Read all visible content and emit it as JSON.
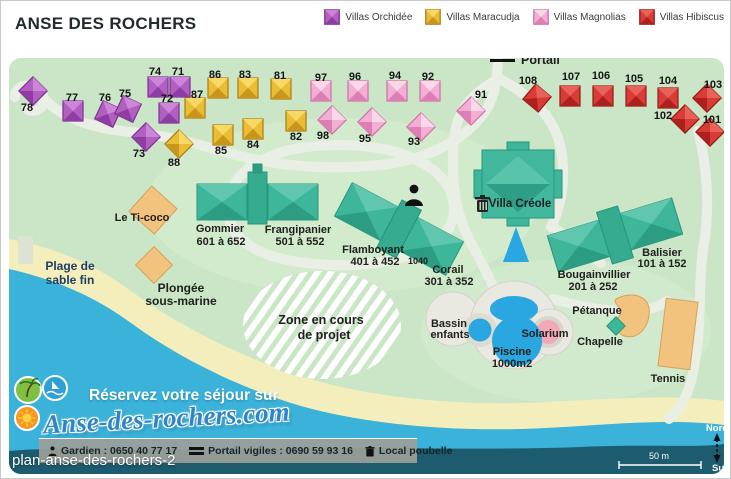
{
  "header": {
    "title": "ANSE DES ROCHERS",
    "legend": [
      {
        "label": "Villas Orchidée",
        "type": "orchidee"
      },
      {
        "label": "Villas Maracudja",
        "type": "maracudja"
      },
      {
        "label": "Villas Magnolias",
        "type": "magnolias"
      },
      {
        "label": "Villas Hibiscus",
        "type": "hibiscus"
      }
    ]
  },
  "map": {
    "villa_types": {
      "orchidee": {
        "light": "#cd85da",
        "mid": "#b160c2",
        "dark": "#8f3da4",
        "edge": "#7c2f92"
      },
      "maracudja": {
        "light": "#f6d967",
        "mid": "#eabd37",
        "dark": "#c9961b",
        "edge": "#ab7d10"
      },
      "magnolias": {
        "light": "#fad7e9",
        "mid": "#f3afd3",
        "dark": "#dd7fb5",
        "edge": "#ce6fa8"
      },
      "hibiscus": {
        "light": "#e8625a",
        "mid": "#d93c37",
        "dark": "#ad201e",
        "edge": "#901815"
      }
    },
    "villas": [
      {
        "n": "78",
        "t": "orchidee",
        "x": 32,
        "y": 90,
        "r": 45,
        "lx": 26,
        "ly": 110
      },
      {
        "n": "77",
        "t": "orchidee",
        "x": 72,
        "y": 110,
        "r": 0,
        "lx": 71,
        "ly": 100
      },
      {
        "n": "76",
        "t": "orchidee",
        "x": 107,
        "y": 113,
        "r": 25,
        "lx": 104,
        "ly": 100
      },
      {
        "n": "75",
        "t": "orchidee",
        "x": 127,
        "y": 108,
        "r": 25,
        "lx": 124,
        "ly": 96
      },
      {
        "n": "74",
        "t": "orchidee",
        "x": 157,
        "y": 86,
        "r": 0,
        "lx": 154,
        "ly": 74
      },
      {
        "n": "71",
        "t": "orchidee",
        "x": 179,
        "y": 86,
        "r": 0,
        "lx": 177,
        "ly": 74
      },
      {
        "n": "72",
        "t": "orchidee",
        "x": 168,
        "y": 112,
        "r": 0,
        "lx": 166,
        "ly": 101
      },
      {
        "n": "73",
        "t": "orchidee",
        "x": 145,
        "y": 136,
        "r": 45,
        "lx": 138,
        "ly": 156
      },
      {
        "n": "88",
        "t": "maracudja",
        "x": 178,
        "y": 143,
        "r": 45,
        "lx": 173,
        "ly": 165
      },
      {
        "n": "87",
        "t": "maracudja",
        "x": 194,
        "y": 107,
        "r": 0,
        "lx": 196,
        "ly": 97
      },
      {
        "n": "86",
        "t": "maracudja",
        "x": 217,
        "y": 87,
        "r": 0,
        "lx": 214,
        "ly": 77
      },
      {
        "n": "83",
        "t": "maracudja",
        "x": 247,
        "y": 87,
        "r": 0,
        "lx": 244,
        "ly": 77
      },
      {
        "n": "81",
        "t": "maracudja",
        "x": 280,
        "y": 88,
        "r": 0,
        "lx": 279,
        "ly": 78
      },
      {
        "n": "85",
        "t": "maracudja",
        "x": 222,
        "y": 134,
        "r": 0,
        "lx": 220,
        "ly": 153
      },
      {
        "n": "84",
        "t": "maracudja",
        "x": 252,
        "y": 128,
        "r": 0,
        "lx": 252,
        "ly": 147
      },
      {
        "n": "82",
        "t": "maracudja",
        "x": 295,
        "y": 120,
        "r": 0,
        "lx": 295,
        "ly": 139
      },
      {
        "n": "97",
        "t": "magnolias",
        "x": 320,
        "y": 90,
        "r": 0,
        "lx": 320,
        "ly": 80
      },
      {
        "n": "96",
        "t": "magnolias",
        "x": 357,
        "y": 90,
        "r": 0,
        "lx": 354,
        "ly": 79
      },
      {
        "n": "94",
        "t": "magnolias",
        "x": 396,
        "y": 90,
        "r": 0,
        "lx": 394,
        "ly": 78
      },
      {
        "n": "92",
        "t": "magnolias",
        "x": 429,
        "y": 90,
        "r": 0,
        "lx": 427,
        "ly": 79
      },
      {
        "n": "98",
        "t": "magnolias",
        "x": 331,
        "y": 119,
        "r": 45,
        "lx": 322,
        "ly": 138
      },
      {
        "n": "95",
        "t": "magnolias",
        "x": 371,
        "y": 121,
        "r": 45,
        "lx": 364,
        "ly": 141
      },
      {
        "n": "93",
        "t": "magnolias",
        "x": 420,
        "y": 126,
        "r": 45,
        "lx": 413,
        "ly": 144
      },
      {
        "n": "91",
        "t": "magnolias",
        "x": 470,
        "y": 110,
        "r": 45,
        "lx": 480,
        "ly": 97
      },
      {
        "n": "108",
        "t": "hibiscus",
        "x": 536,
        "y": 97,
        "r": 40,
        "lx": 527,
        "ly": 83
      },
      {
        "n": "107",
        "t": "hibiscus",
        "x": 569,
        "y": 95,
        "r": 0,
        "lx": 570,
        "ly": 79
      },
      {
        "n": "106",
        "t": "hibiscus",
        "x": 602,
        "y": 95,
        "r": 0,
        "lx": 600,
        "ly": 78
      },
      {
        "n": "105",
        "t": "hibiscus",
        "x": 635,
        "y": 95,
        "r": 0,
        "lx": 633,
        "ly": 81
      },
      {
        "n": "104",
        "t": "hibiscus",
        "x": 667,
        "y": 97,
        "r": 0,
        "lx": 667,
        "ly": 83
      },
      {
        "n": "103",
        "t": "hibiscus",
        "x": 706,
        "y": 97,
        "r": 45,
        "lx": 712,
        "ly": 87
      },
      {
        "n": "102",
        "t": "hibiscus",
        "x": 684,
        "y": 118,
        "r": 45,
        "lx": 662,
        "ly": 118
      },
      {
        "n": "101",
        "t": "hibiscus",
        "x": 709,
        "y": 131,
        "r": 45,
        "lx": 711,
        "ly": 122
      }
    ],
    "labels": [
      {
        "t": "Portail",
        "n": "portail-label",
        "x": 520,
        "y": 63,
        "s": 12.5,
        "a": "start"
      },
      {
        "t": "Le Ti-coco",
        "n": "label-le-ti-coco",
        "x": 141,
        "y": 220
      },
      {
        "t": "Gommier",
        "n": "label-gommier",
        "x": 219,
        "y": 231
      },
      {
        "t": "601 à 652",
        "n": "range-gommier",
        "x": 220,
        "y": 244
      },
      {
        "t": "Frangipanier",
        "n": "label-frangipanier",
        "x": 297,
        "y": 232
      },
      {
        "t": "501 à 552",
        "n": "range-frangipanier",
        "x": 299,
        "y": 244
      },
      {
        "t": "Flamboyant",
        "n": "label-flamboyant",
        "x": 372,
        "y": 252
      },
      {
        "t": "401 à 452",
        "n": "range-flamboyant",
        "x": 374,
        "y": 264
      },
      {
        "t": "1040",
        "n": "label-1040",
        "x": 417,
        "y": 263,
        "s": 9
      },
      {
        "t": "Corail",
        "n": "label-corail",
        "x": 447,
        "y": 272
      },
      {
        "t": "301 à 352",
        "n": "range-corail",
        "x": 448,
        "y": 284
      },
      {
        "t": "Villa Créole",
        "n": "label-villa-creole",
        "x": 519,
        "y": 206,
        "s": 11.5
      },
      {
        "t": "Bougainvillier",
        "n": "label-bougainvillier",
        "x": 593,
        "y": 277
      },
      {
        "t": "201 à 252",
        "n": "range-bougainvillier",
        "x": 592,
        "y": 289
      },
      {
        "t": "Balisier",
        "n": "label-balisier",
        "x": 661,
        "y": 255
      },
      {
        "t": "101 à 152",
        "n": "range-balisier",
        "x": 661,
        "y": 266
      },
      {
        "t": "Plage de",
        "n": "label-plage-1",
        "x": 69,
        "y": 269,
        "s": 12,
        "c": "#1c3e63"
      },
      {
        "t": "sable fin",
        "n": "label-plage-2",
        "x": 69,
        "y": 283,
        "s": 12,
        "c": "#1c3e63"
      },
      {
        "t": "Plongée",
        "n": "label-plongee-1",
        "x": 180,
        "y": 291,
        "s": 12
      },
      {
        "t": "sous-marine",
        "n": "label-plongee-2",
        "x": 180,
        "y": 304,
        "s": 12
      },
      {
        "t": "Zone en cours",
        "n": "label-zone-1",
        "x": 320,
        "y": 323,
        "s": 12.5
      },
      {
        "t": "de projet",
        "n": "label-zone-2",
        "x": 323,
        "y": 338,
        "s": 12.5
      },
      {
        "t": "Bassin",
        "n": "label-bassin-1",
        "x": 448,
        "y": 326
      },
      {
        "t": "enfants",
        "n": "label-bassin-2",
        "x": 449,
        "y": 337
      },
      {
        "t": "Solarium",
        "n": "label-solarium",
        "x": 544,
        "y": 336
      },
      {
        "t": "Piscine",
        "n": "label-piscine-1",
        "x": 511,
        "y": 354
      },
      {
        "t": "1000m2",
        "n": "label-piscine-2",
        "x": 511,
        "y": 366
      },
      {
        "t": "Pétanque",
        "n": "label-petanque",
        "x": 596,
        "y": 313
      },
      {
        "t": "Chapelle",
        "n": "label-chapelle",
        "x": 599,
        "y": 344
      },
      {
        "t": "Tennis",
        "n": "label-tennis",
        "x": 667,
        "y": 381
      },
      {
        "t": "50 m",
        "n": "scale-label",
        "x": 658,
        "y": 458,
        "s": 9,
        "c": "#ffffff",
        "w": 400
      },
      {
        "t": "Nord",
        "n": "compass-north-label",
        "x": 716,
        "y": 430,
        "s": 9.5,
        "c": "#ffffff"
      },
      {
        "t": "Sud",
        "n": "compass-south-label",
        "x": 720,
        "y": 470,
        "s": 9.5,
        "c": "#ffffff"
      }
    ]
  },
  "branding": {
    "tagline": "Réservez votre séjour sur",
    "site": "Anse-des-rochers.com"
  },
  "footer_bar": {
    "items": [
      {
        "icon": "guard-icon",
        "text": "Gardien : 0650 40 77 17"
      },
      {
        "icon": "portal-icon",
        "text": "Portail vigiles : 0690 59 93 16"
      },
      {
        "icon": "trash-icon",
        "text": "Local poubelle"
      }
    ]
  },
  "caption": "plan-anse-des-rochers-2"
}
